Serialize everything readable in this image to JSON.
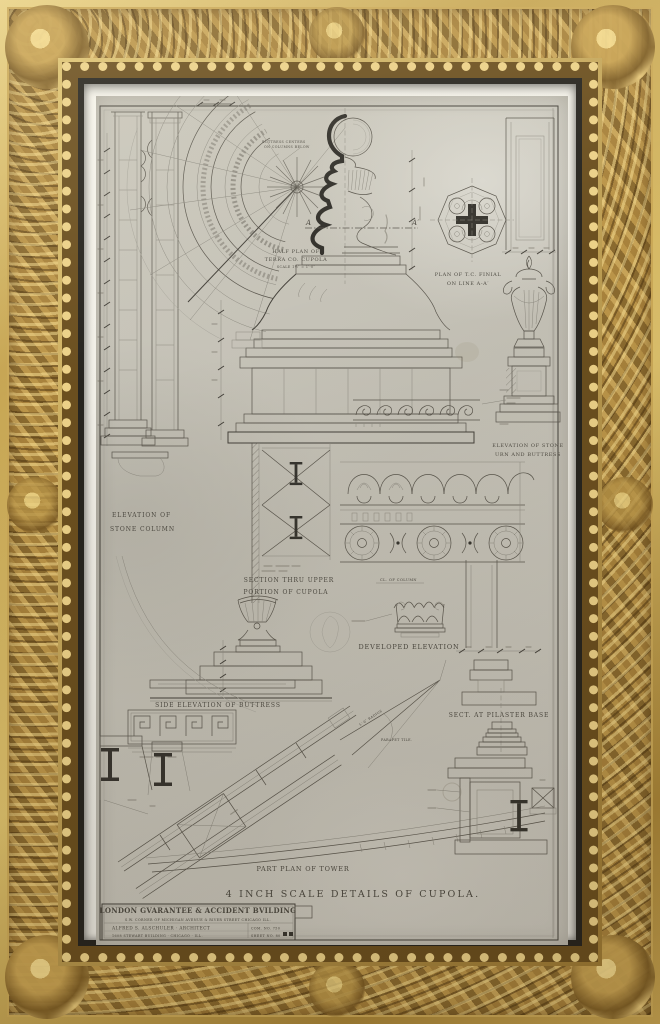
{
  "artwork": {
    "colors": {
      "frame_gold": "#a9853f",
      "mat": "#f1efe8",
      "paper": "#c7c4b9",
      "ink": "#4d4a43"
    },
    "labels": {
      "fan": {
        "l1": "HALF PLAN OF",
        "l2": "TERRA CO. CUPOLA",
        "l3": "SCALE 1½″ = 1′-0″"
      },
      "fan_note": {
        "l1": "BUTTRESS CENTERS",
        "l2": "ON COLUMNS BELOW"
      },
      "stone_column": {
        "l1": "ELEVATION OF",
        "l2": "STONE COLUMN"
      },
      "finial_plan": {
        "l1": "PLAN OF T.C. FINIAL",
        "l2": "ON LINE A-A′"
      },
      "urn": {
        "l1": "ELEVATION OF STONE",
        "l2": "URN AND BUTTRESS"
      },
      "section": {
        "l1": "SECTION THRU UPPER",
        "l2": "PORTION OF CUPOLA"
      },
      "developed": "DEVELOPED ELEVATION",
      "col_center": "CL. OF COLUMN",
      "buttress": "SIDE ELEVATION OF BUTTRESS",
      "pilaster": "SECT. AT PILASTER BASE",
      "part_plan": "PART PLAN OF TOWER",
      "main_title": "4 INCH SCALE DETAILS OF CUPOLA.",
      "marker_a": "A",
      "marker_a_prime": "A′",
      "parapet_tile": "PARAPET TILE.",
      "radius": "5′-6″ RADIUS"
    },
    "title_block": {
      "building": "LONDON GVARANTEE & ACCIDENT BVILDING",
      "address": "S.W. CORNER OF MICHIGAN AVENUE & RIVER STREET CHICAGO ILL.",
      "architect": "ALFRED S. ALSCHULER · ARCHITECT",
      "office": "1608 STEWART BUILDING · CHICAGO · ILL.",
      "com_no": "COM. NO. 750",
      "sheet_no": "SHEET NO. 80"
    }
  }
}
